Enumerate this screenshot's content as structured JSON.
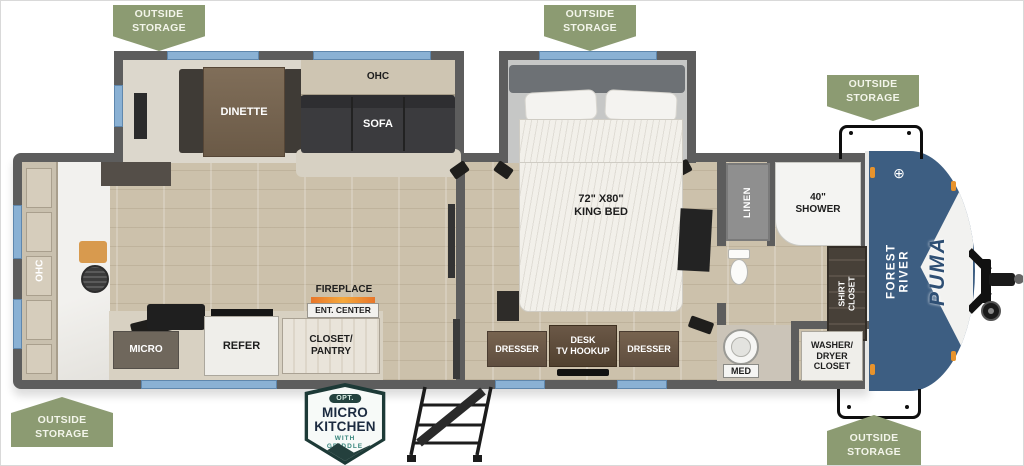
{
  "badges": {
    "outside_storage": "OUTSIDE\nSTORAGE"
  },
  "living": {
    "dinette": "DINETTE",
    "ohc_top": "OHC",
    "sofa": "SOFA",
    "ohc_rear": "OHC",
    "micro": "MICRO",
    "refer": "REFER",
    "fireplace": "FIREPLACE",
    "ent_center": "ENT. CENTER",
    "closet_pantry": "CLOSET/\nPANTRY"
  },
  "bedroom": {
    "king_bed": "72\" X80\"\nKING BED",
    "dresser_left": "DRESSER",
    "desk_tv": "DESK\nTV HOOKUP",
    "dresser_right": "DRESSER"
  },
  "bathroom": {
    "linen": "LINEN",
    "shower": "40\"\nSHOWER",
    "shirt_closet": "SHIRT\nCLOSET",
    "med": "MED",
    "washer_dryer": "WASHER/\nDRYER\nCLOSET"
  },
  "brand": {
    "manufacturer": "FOREST RIVER",
    "model": "PUMA",
    "emblem": "⊕"
  },
  "option_badge": {
    "tag": "OPT.",
    "title": "MICRO\nKITCHEN",
    "subtitle": "WITH\nGRIDDLE"
  },
  "colors": {
    "green": "#8c9b72",
    "wall": "#5d5d5d",
    "window": "#8ab1d4",
    "capblue": "#3d5e82",
    "wood": "#ccc1ab",
    "orange": "#e8932c",
    "teal": "#1d3a37"
  }
}
